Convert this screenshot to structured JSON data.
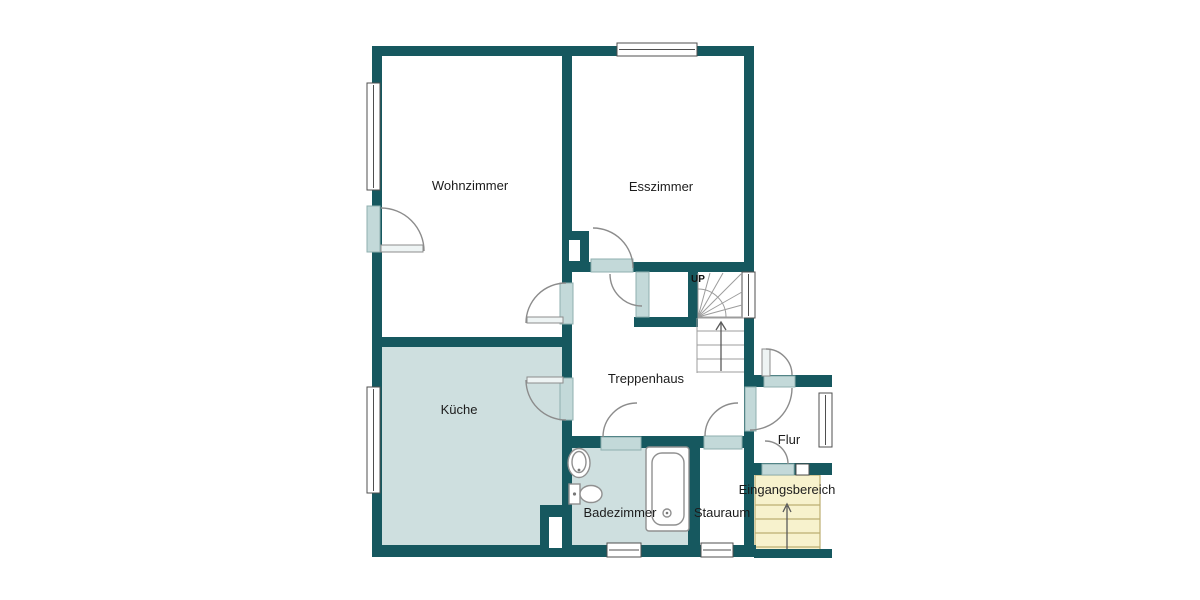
{
  "colors": {
    "wall": "#16585f",
    "room_fill": "#cedfdf",
    "door_panel": "#c3d9d9",
    "stairs_fill": "#f7f2cd",
    "stairs_line": "#bcae72",
    "text": "#1c1c1c"
  },
  "rooms": {
    "wohnzimmer": {
      "label": "Wohnzimmer"
    },
    "esszimmer": {
      "label": "Esszimmer"
    },
    "kueche": {
      "label": "Küche"
    },
    "treppenhaus": {
      "label": "Treppenhaus"
    },
    "badezimmer": {
      "label": "Badezimmer"
    },
    "stauraum": {
      "label": "Stauraum"
    },
    "flur": {
      "label": "Flur"
    },
    "eingangsbereich": {
      "label": "Eingangsbereich"
    }
  },
  "stairs": {
    "up_label": "UP"
  }
}
